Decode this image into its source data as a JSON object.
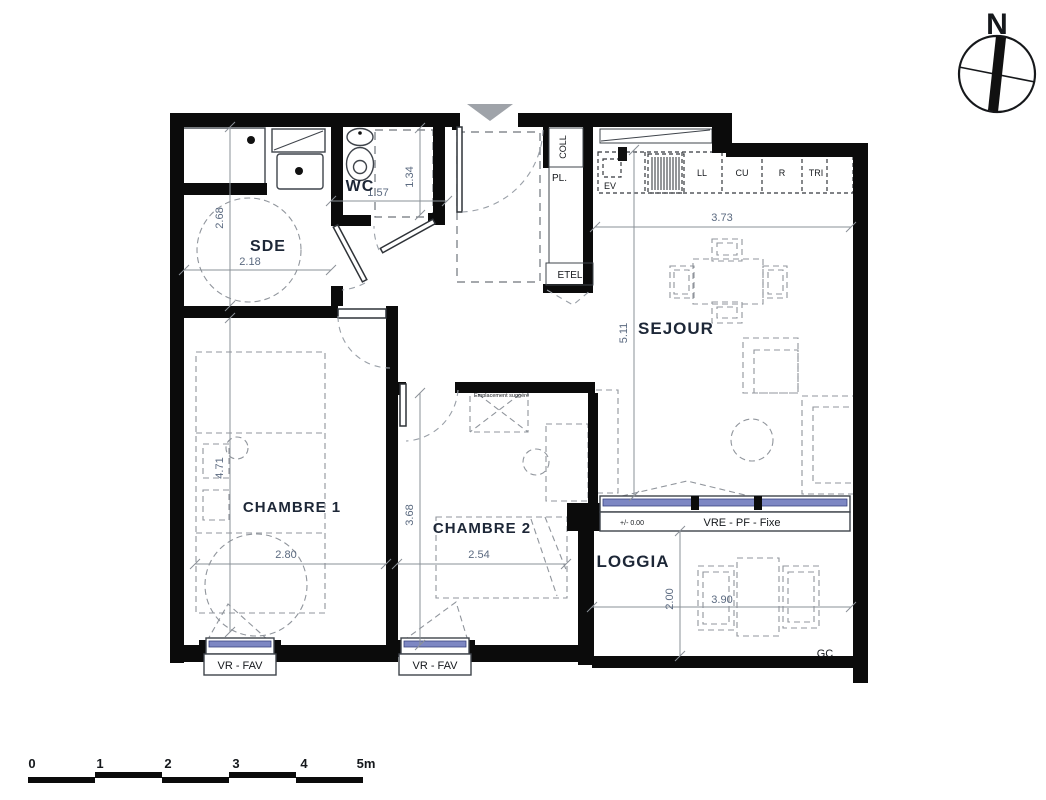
{
  "rooms": {
    "sde": "SDE",
    "wc": "WC",
    "sejour": "SEJOUR",
    "chambre1": "CHAMBRE 1",
    "chambre2": "CHAMBRE 2",
    "loggia": "LOGGIA"
  },
  "closets": {
    "coll": "COLL",
    "pl": "PL.",
    "etel": "ETEL"
  },
  "kitchen": {
    "ev": "EV",
    "ll": "LL",
    "cu": "CU",
    "r": "R",
    "tri": "TRI"
  },
  "windows": {
    "bedroom_label": "VR - FAV",
    "living_label": "VRE - PF - Fixe",
    "level": "+/- 0.00"
  },
  "annotations": {
    "suggested_location": "Emplacement suggéré",
    "gc": "GC"
  },
  "dimensions": {
    "sde_height": "2.68",
    "sde_width": "2.18",
    "wc_height": "1.34",
    "wc_width": "1.57",
    "kitchen_width": "3.73",
    "sejour_height": "5.11",
    "chambre1_height": "4.71",
    "chambre1_width": "2.80",
    "chambre2_width": "2.54",
    "chambre2_height": "3.68",
    "loggia_height": "2.00",
    "loggia_width": "3.90"
  },
  "north": {
    "label": "N"
  },
  "scalebar": {
    "ticks": [
      "0",
      "1",
      "2",
      "3",
      "4",
      "5m"
    ]
  },
  "colors": {
    "wall": "#0b0b0b",
    "glazing": "#7d87c3",
    "entry_arrow": "#9fa3a9",
    "dim_text": "#5b6a80"
  }
}
